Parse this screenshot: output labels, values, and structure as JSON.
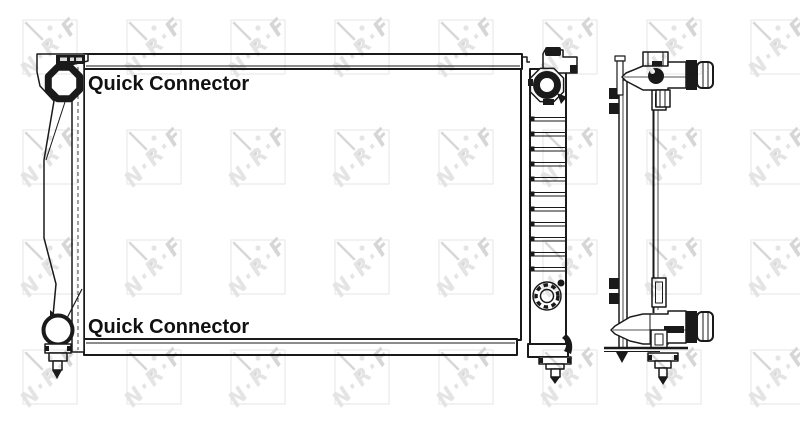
{
  "page": {
    "background_color": "#ffffff"
  },
  "drawing": {
    "line_color": "#1a1a1a"
  },
  "labels": {
    "quick_connector_top": "Quick Connector",
    "quick_connector_bottom": "Quick Connector"
  },
  "watermark": {
    "letters": [
      "N",
      "R",
      "F"
    ],
    "separator": "·",
    "letter_color": "#e4e4e4",
    "f_letter_color": "#d6d6d6",
    "square_color": "#e8e8e8",
    "accent_color": "#d8d8d8"
  }
}
